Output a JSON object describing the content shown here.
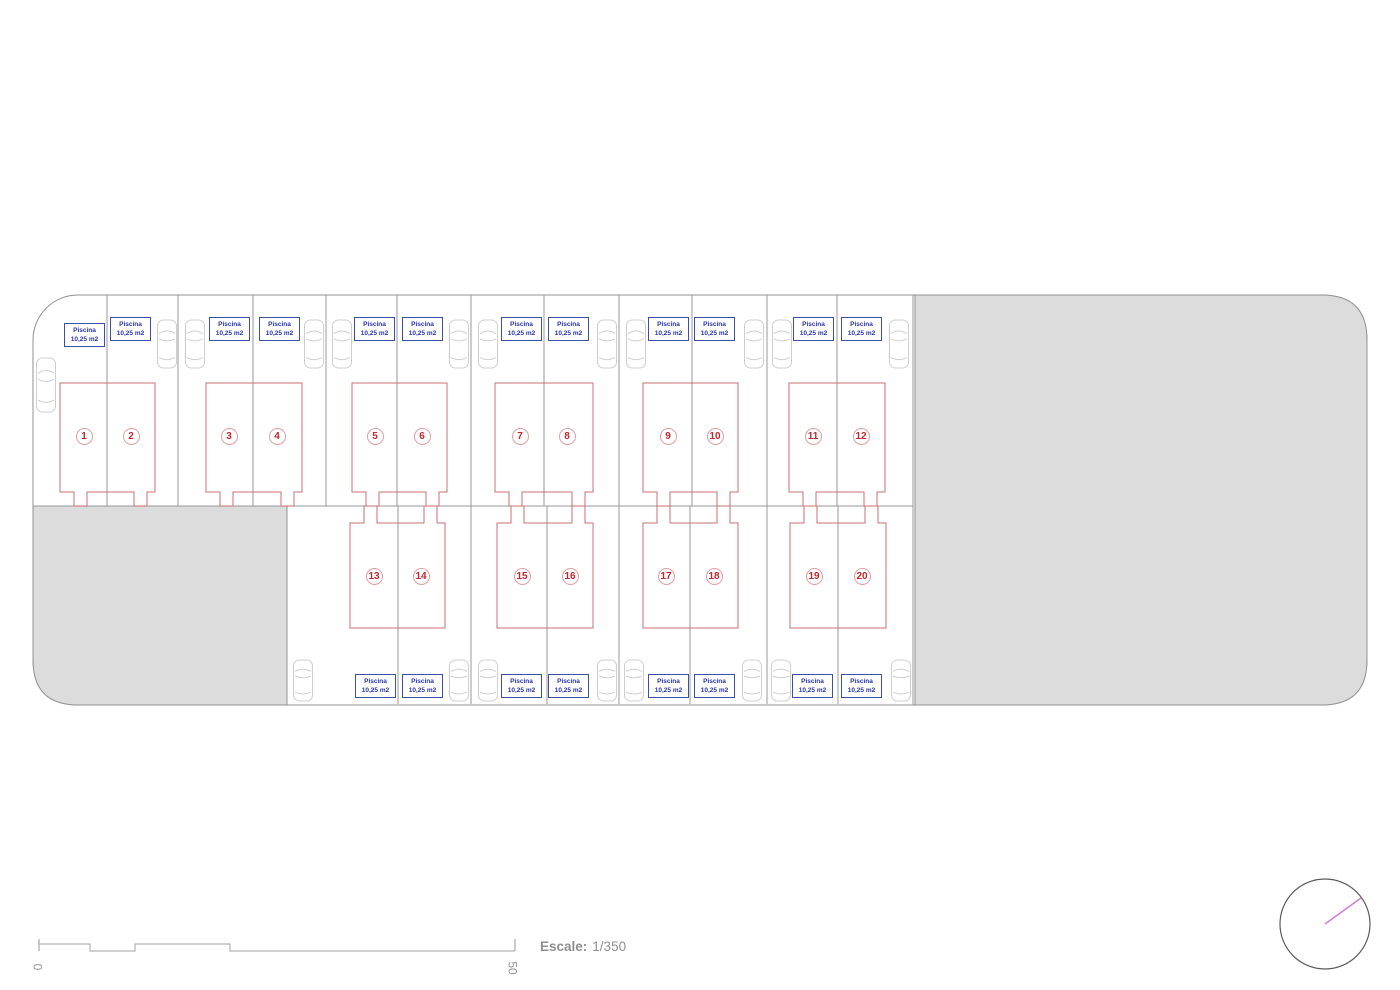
{
  "colors": {
    "boundary_line": "#909090",
    "lot_line": "#9a9a9a",
    "gray_fill": "#dcdcdc",
    "building_outline": "#c87070",
    "number_text": "#c1272d",
    "number_circle": "#e09f9f",
    "pool_border": "#3a50a2",
    "pool_text": "#2633ae",
    "car_outline": "#cfcfcf",
    "scale_line": "#b3b3b3",
    "scale_text": "#8f8f8f",
    "compass_ring": "#5a5a5a",
    "compass_needle": "#cd7fd6"
  },
  "site": {
    "boundary": {
      "x": 33,
      "y": 295,
      "w": 1334,
      "h": 410,
      "r": 45
    },
    "gray_right": {
      "x": 915,
      "y": 295,
      "w": 452,
      "h": 410,
      "r": 45
    },
    "gray_left": {
      "x": 33,
      "y": 506,
      "w": 254,
      "h": 199,
      "r": 45
    },
    "row_divider": {
      "x1": 33,
      "x2": 913,
      "y": 506
    },
    "right_edge_x": 913,
    "top_lines": [
      107,
      178,
      253,
      326,
      397,
      471,
      544,
      619,
      692,
      767,
      837
    ],
    "top_line_y": [
      295,
      506
    ],
    "bottom_lines": [
      398,
      471,
      547,
      619,
      690,
      767,
      838
    ],
    "bottom_line_y": [
      506,
      704
    ]
  },
  "buildings": {
    "notch": {
      "w": 13,
      "left_inset": 14,
      "right_inset": 8
    },
    "top": {
      "y": 383,
      "bottom": 492,
      "notch_edge": 506,
      "items": [
        {
          "x": 60,
          "w": 95
        },
        {
          "x": 206,
          "w": 96
        },
        {
          "x": 352,
          "w": 95
        },
        {
          "x": 495,
          "w": 98
        },
        {
          "x": 643,
          "w": 95
        },
        {
          "x": 789,
          "w": 96
        }
      ]
    },
    "bottom": {
      "y": 523,
      "bottom": 628,
      "notch_edge": 506,
      "items": [
        {
          "x": 350,
          "w": 95
        },
        {
          "x": 497,
          "w": 96
        },
        {
          "x": 643,
          "w": 95
        },
        {
          "x": 790,
          "w": 96
        }
      ]
    }
  },
  "pool_label": {
    "line1": "Piscina",
    "line2": "10,25 m2"
  },
  "units": [
    {
      "number": "1",
      "row": "top",
      "cx": 84,
      "cy": 436,
      "pool_x": 64,
      "pool_y": 323
    },
    {
      "number": "2",
      "row": "top",
      "cx": 131,
      "cy": 436,
      "pool_x": 110,
      "pool_y": 317
    },
    {
      "number": "3",
      "row": "top",
      "cx": 229,
      "cy": 436,
      "pool_x": 209,
      "pool_y": 317
    },
    {
      "number": "4",
      "row": "top",
      "cx": 277,
      "cy": 436,
      "pool_x": 259,
      "pool_y": 317
    },
    {
      "number": "5",
      "row": "top",
      "cx": 375,
      "cy": 436,
      "pool_x": 354,
      "pool_y": 317
    },
    {
      "number": "6",
      "row": "top",
      "cx": 422,
      "cy": 436,
      "pool_x": 402,
      "pool_y": 317
    },
    {
      "number": "7",
      "row": "top",
      "cx": 520,
      "cy": 436,
      "pool_x": 501,
      "pool_y": 317
    },
    {
      "number": "8",
      "row": "top",
      "cx": 567,
      "cy": 436,
      "pool_x": 548,
      "pool_y": 317
    },
    {
      "number": "9",
      "row": "top",
      "cx": 668,
      "cy": 436,
      "pool_x": 648,
      "pool_y": 317
    },
    {
      "number": "10",
      "row": "top",
      "cx": 715,
      "cy": 436,
      "pool_x": 694,
      "pool_y": 317
    },
    {
      "number": "11",
      "row": "top",
      "cx": 813,
      "cy": 436,
      "pool_x": 793,
      "pool_y": 317
    },
    {
      "number": "12",
      "row": "top",
      "cx": 861,
      "cy": 436,
      "pool_x": 841,
      "pool_y": 317
    },
    {
      "number": "13",
      "row": "bottom",
      "cx": 374,
      "cy": 576,
      "pool_x": 355,
      "pool_y": 674
    },
    {
      "number": "14",
      "row": "bottom",
      "cx": 421,
      "cy": 576,
      "pool_x": 402,
      "pool_y": 674
    },
    {
      "number": "15",
      "row": "bottom",
      "cx": 522,
      "cy": 576,
      "pool_x": 501,
      "pool_y": 674
    },
    {
      "number": "16",
      "row": "bottom",
      "cx": 570,
      "cy": 576,
      "pool_x": 548,
      "pool_y": 674
    },
    {
      "number": "17",
      "row": "bottom",
      "cx": 666,
      "cy": 576,
      "pool_x": 648,
      "pool_y": 674
    },
    {
      "number": "18",
      "row": "bottom",
      "cx": 714,
      "cy": 576,
      "pool_x": 694,
      "pool_y": 674
    },
    {
      "number": "19",
      "row": "bottom",
      "cx": 814,
      "cy": 576,
      "pool_x": 792,
      "pool_y": 674
    },
    {
      "number": "20",
      "row": "bottom",
      "cx": 862,
      "cy": 576,
      "pool_x": 841,
      "pool_y": 674
    }
  ],
  "cars": {
    "w": 20,
    "top": {
      "y": 318,
      "h": 52,
      "xs": [
        157,
        185,
        304,
        332,
        449,
        478,
        597,
        626,
        744,
        772,
        889
      ]
    },
    "bottom": {
      "y": 658,
      "h": 45,
      "xs": [
        293,
        449,
        478,
        597,
        624,
        742,
        771,
        891
      ]
    },
    "corner": {
      "x": 36,
      "y": 356,
      "h": 58
    }
  },
  "scale_bar": {
    "ticks": [
      39,
      515
    ],
    "tick_y": [
      939,
      951
    ],
    "top_y": 944,
    "bot_y": 951,
    "steps": [
      90,
      135,
      230
    ],
    "label_start": "0",
    "label_end": "50",
    "caption_bold": "Escale:",
    "caption_value": "1/350"
  },
  "compass": {
    "cx": 1325,
    "cy": 924,
    "r": 45,
    "needle_x2": 1361,
    "needle_y2": 898
  }
}
